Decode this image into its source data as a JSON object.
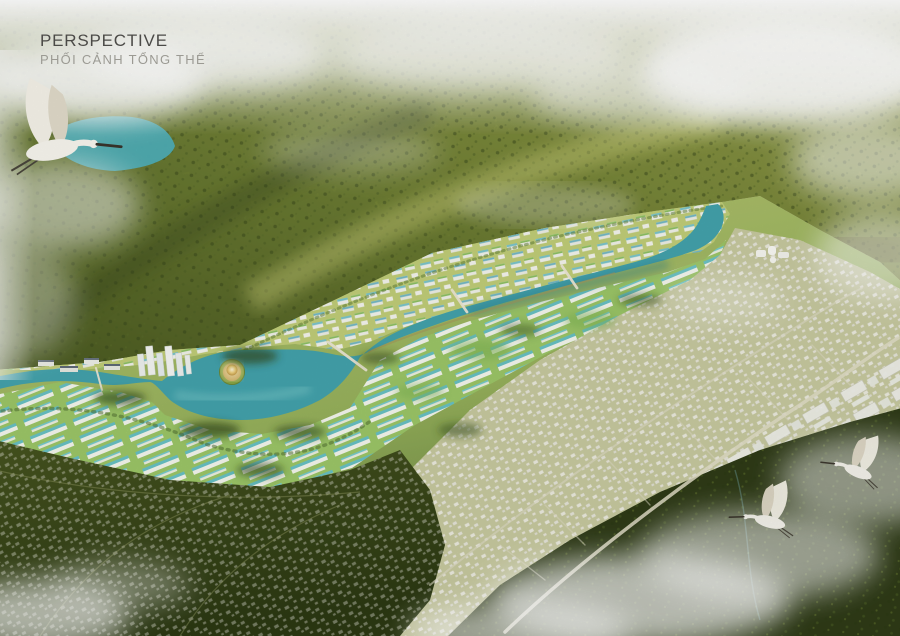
{
  "title": {
    "en": "PERSPECTIVE",
    "vi": "PHỐI CẢNH TỔNG THỂ"
  },
  "scene": {
    "type": "aerial-masterplan-perspective-rendering",
    "landmarks": [
      "forested-mountain-ridge",
      "mountain-lake",
      "flying-spoonbill-bird",
      "riverfront-new-town",
      "central-lake-with-golden-island",
      "winding-river",
      "bridges",
      "lakeside-townhouse-rows",
      "existing-town-grid",
      "highway-road",
      "dark-farmland",
      "misty-forest",
      "two-flying-birds"
    ]
  },
  "colors": {
    "haze": "#ffffff",
    "forest_light": "#b9bd67",
    "forest_mid": "#7d8c38",
    "forest_dark": "#49571f",
    "water": "#43a3ad",
    "water_light": "#8fd7d2",
    "water_dark": "#2a7e8c",
    "upper_lake": "#4fb0b8",
    "island_glow": "#ffeebb",
    "island_sand": "#caa85c",
    "roof_teal": "#6cc4cc",
    "roof_green": "#8cc060",
    "building_white": "#f3f3ec",
    "town_base": "#c8caa0",
    "farmland_dark": "#3c4a1e",
    "bottom_forest": "#2f3b17",
    "road": "#e3dfc8",
    "text_primary": "#4b4a47",
    "text_secondary": "#9b9a93"
  }
}
